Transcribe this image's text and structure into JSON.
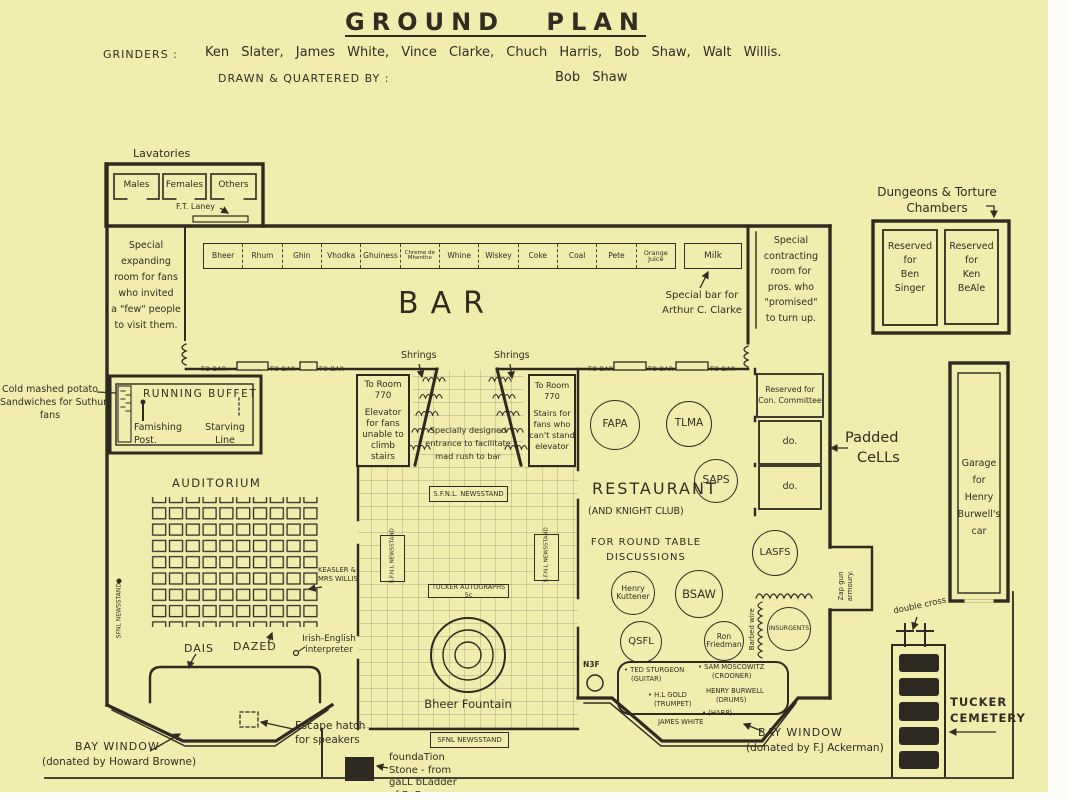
{
  "page": {
    "background": "#f0edaf",
    "ink": "#332c22"
  },
  "header": {
    "title": "GROUND PLAN",
    "credits_label": "GRINDERS :",
    "credits": "Ken Slater,  James White,  Vince Clarke,  Chuch Harris,  Bob Shaw,  Walt Willis.",
    "drawn_label": "DRAWN & QUARTERED BY :",
    "drawn_by": "Bob Shaw"
  },
  "lavatories": {
    "label": "Lavatories",
    "rooms": [
      "Males",
      "Females",
      "Others"
    ],
    "attendant": "F.T. Laney"
  },
  "expanding_room": {
    "lines": [
      "Special",
      "expanding",
      "room for fans",
      "who invited",
      "a \"few\" people",
      "to visit them."
    ]
  },
  "bar": {
    "title": "BAR",
    "shelf": [
      "Bheer",
      "Rhum",
      "Ghin",
      "Vhodka",
      "Ghuiness",
      "Chreme de Mhenthe",
      "Whine",
      "Wiskey",
      "Coke",
      "Coal",
      "Pete",
      "Orange Juice"
    ],
    "milk": "Milk",
    "clarke_note": [
      "Special bar for",
      "Arthur C. Clarke"
    ]
  },
  "corridor": {
    "to_bar": "TO BAR"
  },
  "contracting_room": {
    "lines": [
      "Special",
      "contracting",
      "room  for",
      "pros. who",
      "\"promised\"",
      "to turn up."
    ]
  },
  "dungeons": {
    "label": [
      "Dungeons & Torture",
      "Chambers"
    ],
    "cell_left": [
      "Reserved",
      "for",
      "Ben",
      "Singer"
    ],
    "cell_right": [
      "Reserved",
      "for",
      "Ken",
      "BeAle"
    ]
  },
  "buffet": {
    "note": [
      "Cold mashed potato",
      "Sandwiches for Suthun",
      "fans"
    ],
    "title": "RUNNING BUFFET",
    "post": [
      "Famishing",
      "Post."
    ],
    "line": [
      "Starving",
      "Line"
    ]
  },
  "entrance": {
    "springs": "Shrings",
    "left_room": [
      "To Room",
      "770"
    ],
    "left_desc": [
      "Elevator",
      "for fans",
      "unable to",
      "climb",
      "stairs"
    ],
    "right_room": [
      "To Room",
      "770"
    ],
    "right_desc": [
      "Stairs for",
      "fans who",
      "can't stand",
      "elevator"
    ],
    "note": [
      "Specially designed",
      "entrance to facilitate",
      "mad rush to bar"
    ]
  },
  "lobby": {
    "newsstand_top": "S.F.N.L. NEWSSTAND",
    "newsstand_left": "S.F.N.L NEWSSTAND",
    "newsstand_right": "S.F.N.L NEWSSTAND",
    "tucker": "TUCKER AUTOGRAPHS 5c",
    "fountain": "Bheer Fountain",
    "newsstand_bottom": "SFNL NEWSSTAND",
    "foundation": [
      "foundaTion",
      "Stone - from",
      "gaLL bLadder",
      "of  BoB"
    ]
  },
  "auditorium": {
    "title": "AUDITORIUM",
    "newsstand": "SFNL NEWSSTAND",
    "keasler": [
      "KEASLER &",
      "MRS WILLIS"
    ],
    "dais": "DAIS",
    "dazed": "DAZED",
    "interpreter": [
      "Irish-English",
      "interpreter"
    ],
    "bay_window": [
      "BAY WINDOW",
      "(donated by Howard Browne)"
    ],
    "escape": [
      "Escape hatch",
      "for speakers"
    ]
  },
  "restaurant": {
    "title": "RESTAURANT",
    "subtitle": "(AND KNIGHT CLUB)",
    "note": [
      "FOR ROUND TABLE",
      "DISCUSSIONS"
    ],
    "tables": {
      "fapa": "FAPA",
      "tlma": "TLMA",
      "saps": "SAPS",
      "lasfs": "LASFS",
      "kuttener": "Henry Kuttener",
      "bsaw": "BSAW",
      "qsfl": "QSFL",
      "friedman": "Ron Friedman",
      "insurgents": "INSURGENTS",
      "n3f": "N3F"
    },
    "barbed_wire": "Barbed wire",
    "band": [
      [
        "TED STURGEON",
        "(GUITAR)"
      ],
      [
        "SAM MOSCOWITZ",
        "(CROONER)"
      ],
      [
        "H.L GOLD",
        "(TRUMPET)"
      ],
      [
        "HENRY BURWELL",
        "(DRUMS)"
      ],
      [
        "(HARP)",
        "JAMES WHITE"
      ]
    ],
    "bay_window": [
      "BAY WINDOW",
      "(donated by F.J Ackerman)"
    ]
  },
  "cells": {
    "committee": [
      "Reserved for",
      "Con. Committee"
    ],
    "ditto1": "do.",
    "ditto2": "do.",
    "padded": [
      "Padded",
      "CeLLs"
    ],
    "armoury": [
      "Zap gun",
      "armoury."
    ]
  },
  "garage": {
    "lines": [
      "Garage",
      "for",
      "Henry",
      "Burwell's",
      "car"
    ]
  },
  "cemetery": {
    "double_cross": "double cross",
    "name": [
      "TUCKER",
      "CEMETERY"
    ]
  }
}
